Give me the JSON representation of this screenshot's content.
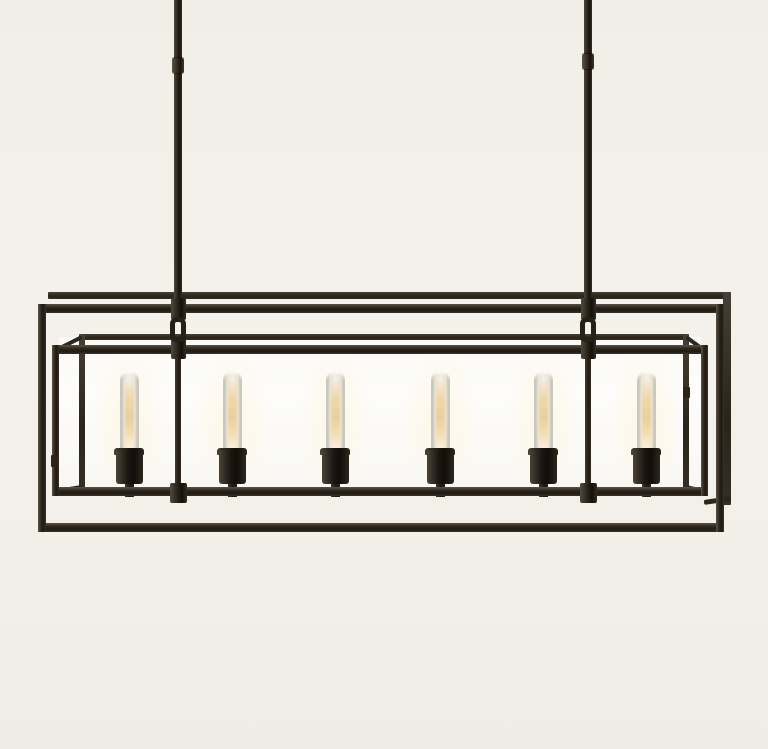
{
  "scene": {
    "subject": "six-light linear box-frame chandelier, dark bronze finish, unlit room, product photo on cream background",
    "colors": {
      "background": "#f2efe8",
      "glass": "#fbfaf6",
      "metal_dark": "#241e16",
      "metal_highlight": "#5a5346",
      "bulb_glow": "#eccf9e",
      "bulb_glass": "#f5f0e4"
    },
    "canvas": {
      "width": 768,
      "height": 749
    },
    "suspensions": [
      {
        "cx": 178,
        "coupling_y": 58
      },
      {
        "cx": 588,
        "coupling_y": 54
      }
    ],
    "rod": {
      "w": 8,
      "top": -4,
      "bottom": 308,
      "coupling_w": 12,
      "coupling_h": 15
    },
    "outer_frame": {
      "left": 38,
      "right": 724,
      "top": 304,
      "bottom": 532,
      "bar": 9,
      "edge": 8,
      "back_top_y": 292,
      "back_bar": 7,
      "back_right_left": 723,
      "back_right_w": 8,
      "back_right_bottom": 505,
      "back_stub_y": 497
    },
    "case_frame": {
      "left": 52,
      "right": 708,
      "top": 345,
      "bottom": 496,
      "bar": 9,
      "edge": 7,
      "back_left": 79,
      "back_right": 683,
      "back_top": 334,
      "back_bottom": 484,
      "back_bar": 6
    },
    "hinges": [
      {
        "x": 683,
        "y": 387,
        "w": 7,
        "h": 11
      },
      {
        "x": 51,
        "y": 455,
        "w": 7,
        "h": 12
      }
    ],
    "bulbs": {
      "count": 6,
      "centers_x": [
        129,
        232,
        335,
        440,
        543,
        646
      ],
      "tube_w": 19,
      "tube_top": 371,
      "tube_h": 80,
      "glow_w": 9,
      "glow_top": 381,
      "glow_h": 67,
      "cap_w": 30,
      "cap_top": 448,
      "cap_h": 7,
      "socket_w": 27,
      "socket_top": 451,
      "socket_h": 33,
      "stem_w": 9,
      "stem_top": 484,
      "stem_h": 13,
      "halo_w": 76,
      "halo_h": 142,
      "halo_cy": 415
    },
    "hardware": {
      "rod_clamp_w": 15,
      "rod_clamp_top": 298,
      "rod_clamp_h": 22,
      "loop_w": 16,
      "loop_top": 317,
      "loop_h": 25,
      "case_clamp_w": 15,
      "case_clamp_top": 338,
      "case_clamp_h": 21,
      "post_w": 6,
      "post_top": 359,
      "post_bottom": 487,
      "collar_w": 17,
      "collar_top": 483,
      "collar_h": 20
    }
  }
}
